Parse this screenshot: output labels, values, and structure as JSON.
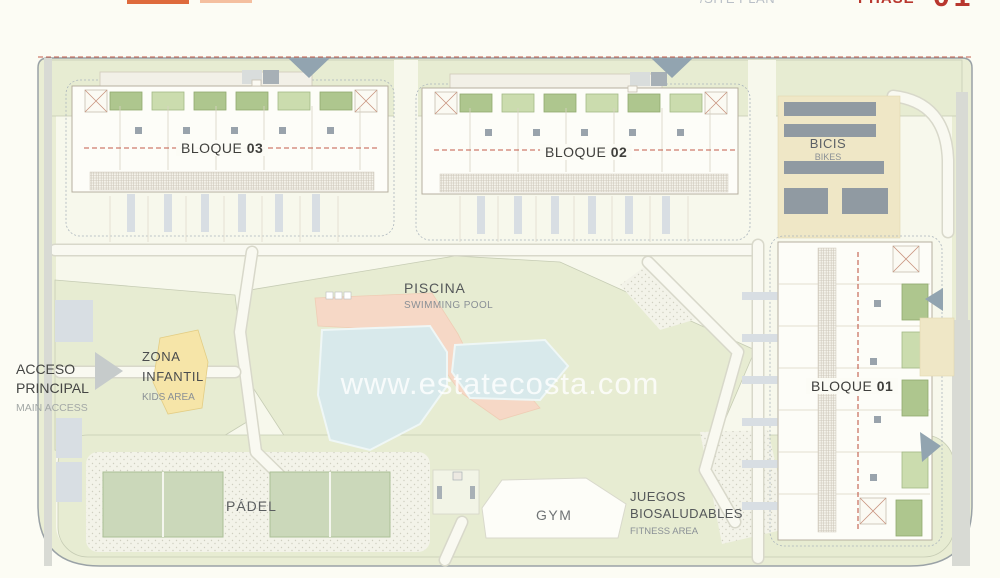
{
  "header": {
    "plan_label": "/SITE PLAN",
    "phase_label": "PHASE",
    "phase_number": "01"
  },
  "watermark": "www.estatecosta.com",
  "labels": {
    "bloque_03": {
      "label": "BLOQUE",
      "number": "03"
    },
    "bloque_02": {
      "label": "BLOQUE",
      "number": "02"
    },
    "bloque_01": {
      "label": "BLOQUE",
      "number": "01"
    },
    "bicis": {
      "es": "BICIS",
      "en": "BIKES"
    },
    "piscina": {
      "es": "PISCINA",
      "en": "SWIMMING POOL"
    },
    "zona_infantil": {
      "es_line1": "ZONA",
      "es_line2": "INFANTIL",
      "en": "KIDS AREA"
    },
    "acceso": {
      "es_line1": "ACCESO",
      "es_line2": "PRINCIPAL",
      "en": "MAIN ACCESS"
    },
    "padel": {
      "es": "PÁDEL"
    },
    "gym": {
      "es": "GYM"
    },
    "juegos": {
      "es_line1": "JUEGOS",
      "es_line2": "BIOSALUDABLES",
      "en": "FITNESS AREA"
    }
  },
  "colors": {
    "background": "#FCFCF4",
    "site_lawn": "#E7ECD2",
    "path_white": "#F9F9F1",
    "building_fill": "#FDFDF8",
    "building_outline": "#B6AF9F",
    "green_roof": "#AEC68E",
    "pool_water": "#D8E9EB",
    "pool_deck": "#F6D8C6",
    "kids_area_yellow": "#F6E5A8",
    "padel_court": "#CBD8BA",
    "bike_rack": "#77848E",
    "road_gray": "#D8DAD4",
    "boundary_red_dash": "#C25B4A",
    "label_dark": "#3F3F3C",
    "label_gray": "#8A9096",
    "phase_red": "#B8372E",
    "logo_orange": "#DE6A3C",
    "marker_triangle": "#92A4B0"
  }
}
